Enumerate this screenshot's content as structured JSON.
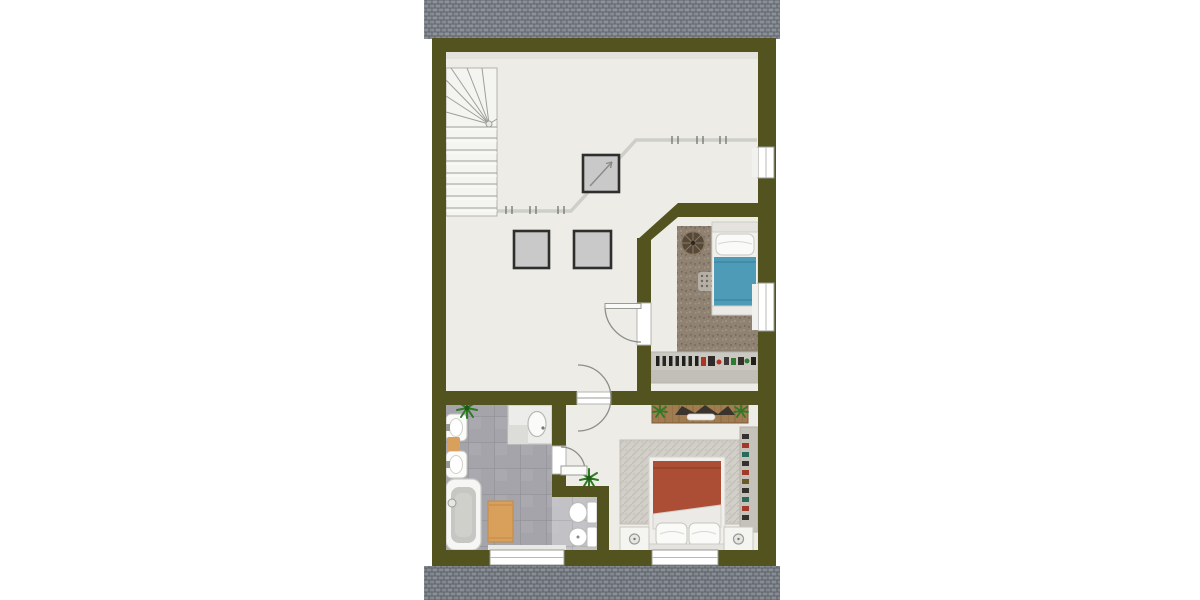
{
  "scene": {
    "kind": "floor-plan",
    "view": "top-down"
  },
  "colors": {
    "wall": "#53531f",
    "floor": "#edece7",
    "roof_base": "#9aa0a7",
    "roof_line": "#5e6268",
    "bath_tile": "#a4a4aa",
    "bath_tile_light": "#c2c2c6",
    "tile_grid": "#8b8b92",
    "blue_duvet": "#4e9bb8",
    "red_duvet": "#ab4e35",
    "carpet_brown": "#8f8272",
    "rug_gray": "#d2cfc8",
    "wood": "#a07c50",
    "mat_orange": "#d8a05a",
    "plant_green": "#3f8f2f",
    "shelf_gray": "#cbc8c2",
    "knee_line": "#cfcfca",
    "door_line": "#8d8d8a",
    "skylight_fill": "#c9c9c9",
    "skylight_border": "#2e2e2c",
    "stair_tread": "#9e9e9a",
    "fixture_white": "#fafaf8"
  },
  "inventory": [
    "roof-shingles-top",
    "roof-shingles-bottom",
    "exterior-walls",
    "interior-walls",
    "staircase-winder",
    "knee-wall-line",
    "skylight-with-arrow",
    "skylight",
    "skylight",
    "window",
    "window",
    "window",
    "window",
    "door-top-bedroom",
    "door-double-swing-hall",
    "door-bathroom",
    "bedroom-top: carpet, single-bed-blue, round-rug, dot-rug, shelf-with-books",
    "bedroom-bottom: dresser, plants, gray-rug, double-bed-red, nightstands, wall-shelf",
    "bathroom: plant, two-sinks, orange-mats, shower, bathtub, toilet, bidet"
  ]
}
